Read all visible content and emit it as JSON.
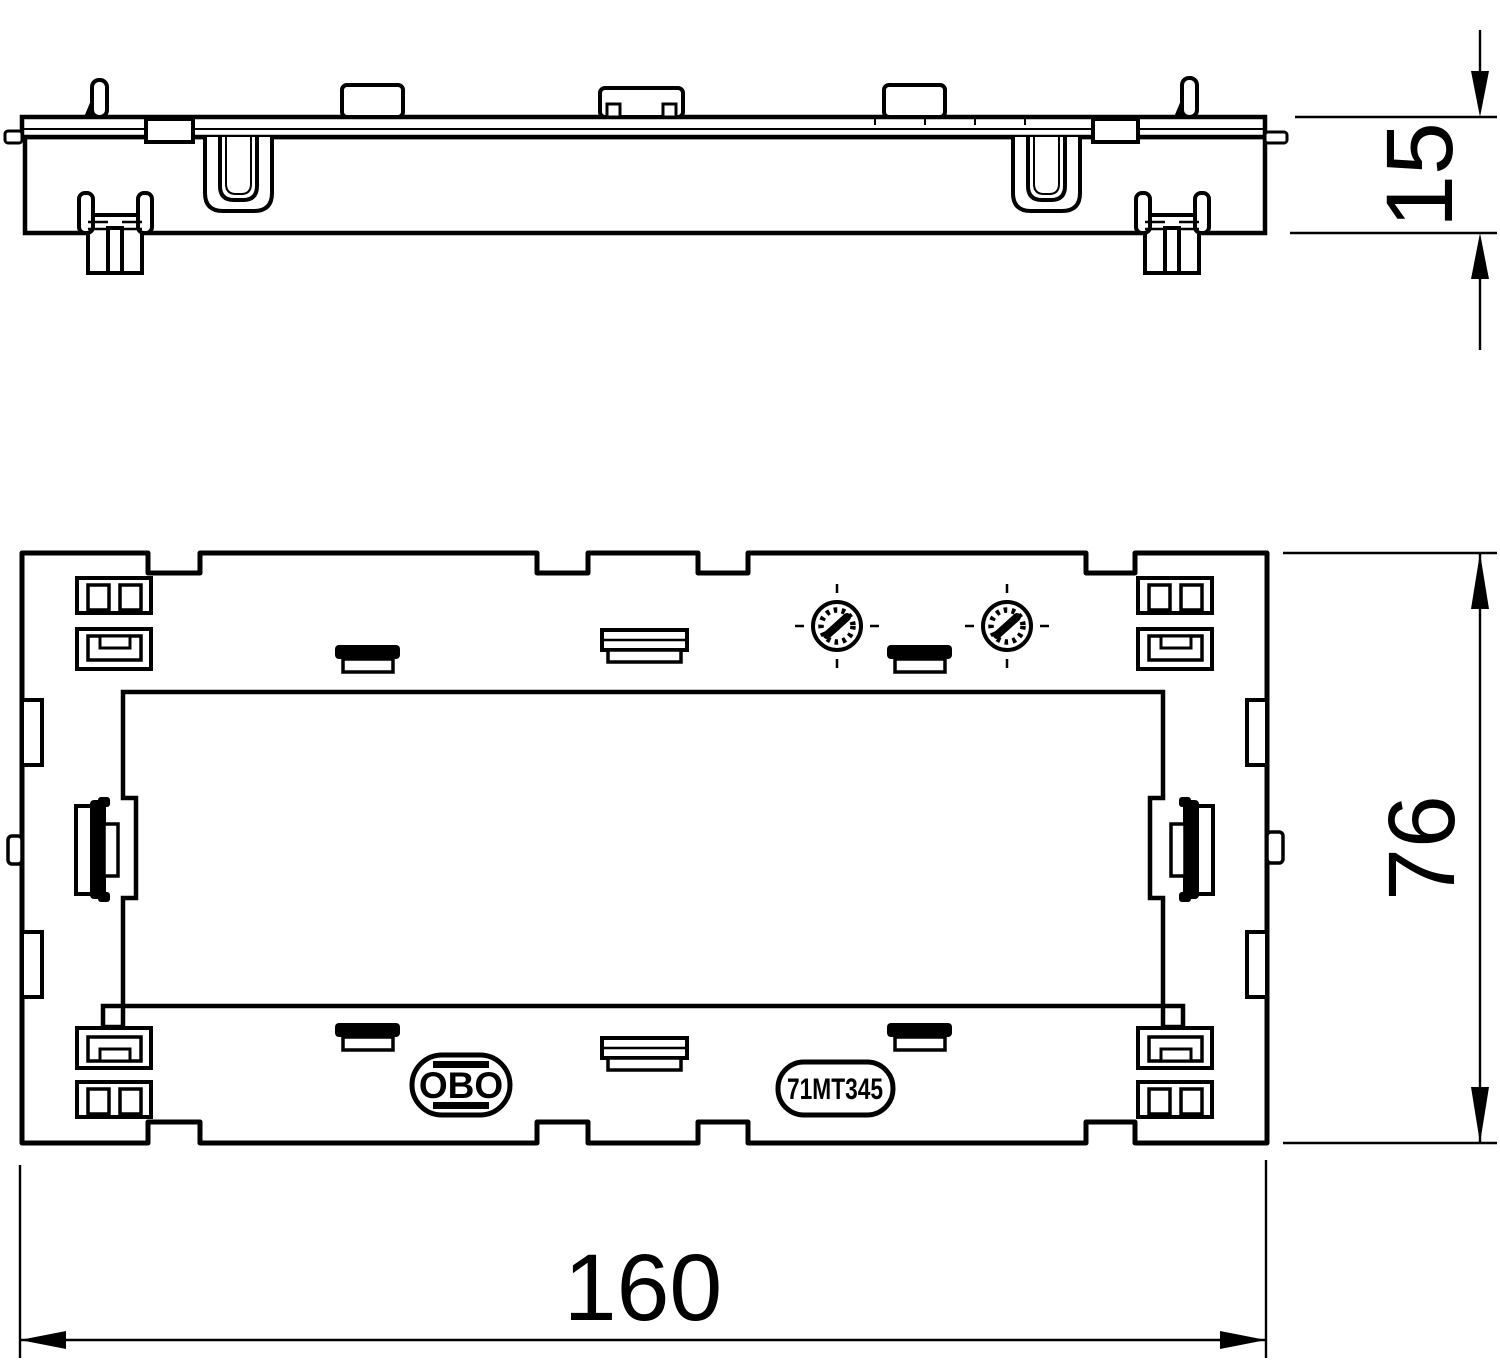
{
  "drawing": {
    "type": "technical-drawing",
    "side_view": {
      "thickness_dim": "15"
    },
    "front_view": {
      "height_dim": "76",
      "width_dim": "160",
      "brand": "OBO",
      "part_number": "71MT345"
    },
    "colors": {
      "line": "#000000",
      "background": "#ffffff"
    }
  }
}
